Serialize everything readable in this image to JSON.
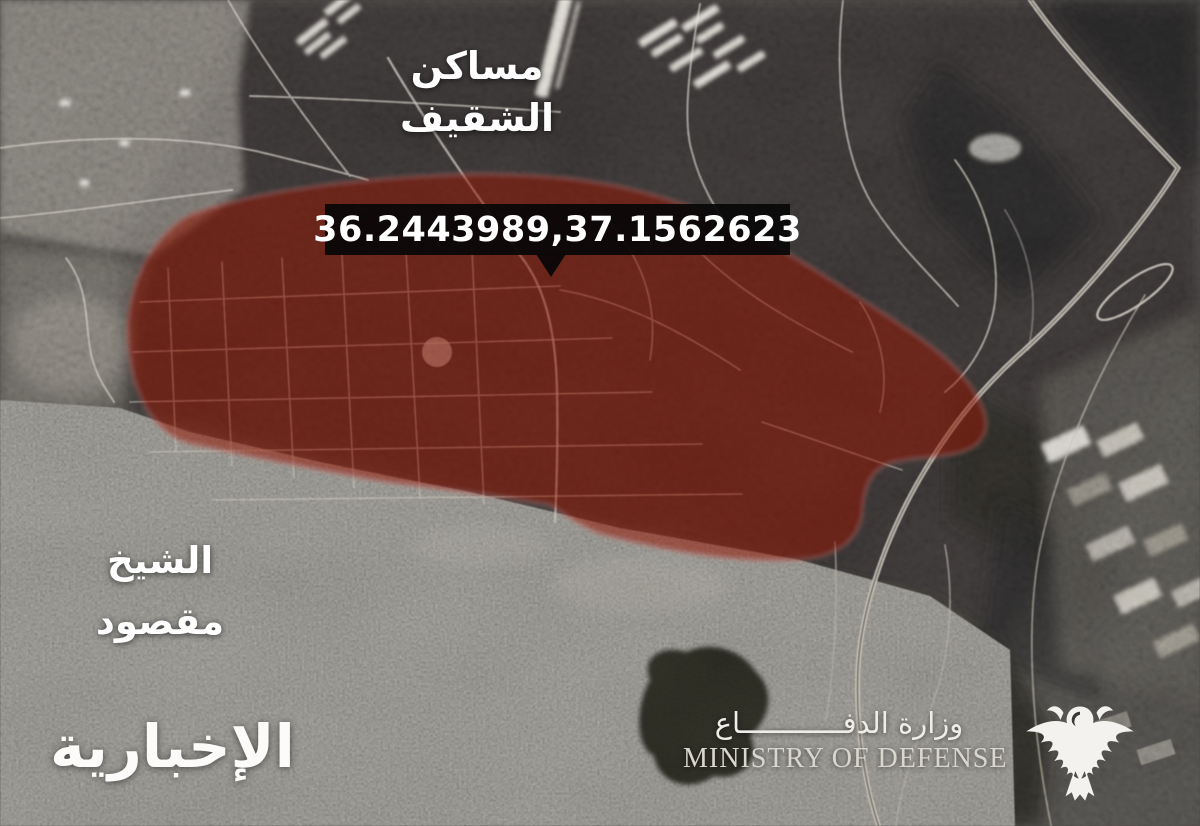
{
  "frame": {
    "description": "Annotated grayscale satellite map with red highlighted zone",
    "width": 1200,
    "height": 826
  },
  "marker": {
    "coordinates": "36.2443989,37.1562623"
  },
  "region_labels": {
    "masaken_shaqif": {
      "line1": "مساكن",
      "line2": "الشقيف"
    },
    "sheikh_maqsoud": {
      "line1": "الشيخ",
      "line2": "مقصود"
    }
  },
  "branding": {
    "news_channel_logo": "الإخبارية",
    "ministry_arabic": "وزارة الدفــــــــــــاع",
    "ministry_english": "MINISTRY OF DEFENSE",
    "eagle_icon": "mod-eagle-emblem"
  },
  "colors": {
    "highlight_red": "#96150a",
    "highlight_edge": "#d98c80",
    "callout_bg": "#080808",
    "callout_text": "#ffffff",
    "label_text": "#ffffff"
  }
}
